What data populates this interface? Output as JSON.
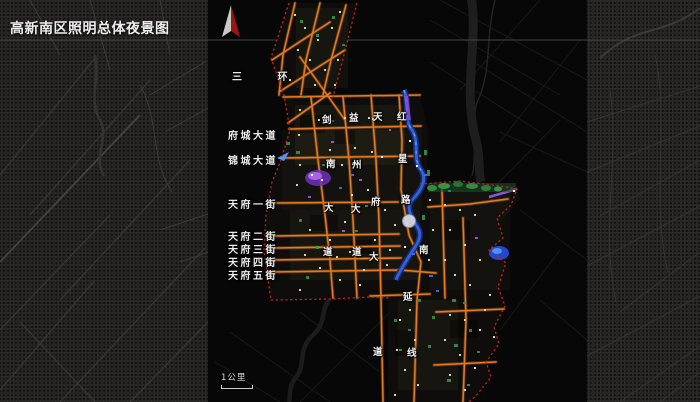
{
  "header": {
    "title": "高新南区照明总体夜景图"
  },
  "margin_labels": {
    "items": [
      {
        "text": "三 环"
      },
      {
        "text": "府城大道"
      },
      {
        "text": "锦城大道"
      },
      {
        "text": "天府一街"
      },
      {
        "text": "天府二街"
      },
      {
        "text": "天府三街"
      },
      {
        "text": "天府四街"
      },
      {
        "text": "天府五街"
      }
    ]
  },
  "map_road_labels": {
    "jiannan": {
      "name": "剑南大道",
      "chars": [
        "剑",
        "南",
        "大",
        "道"
      ]
    },
    "yizhou": {
      "name": "益州大道",
      "chars": [
        "益",
        "州",
        "大",
        "道"
      ]
    },
    "tianfu": {
      "name": "天府大道",
      "chars": [
        "天",
        "府",
        "大",
        "道"
      ]
    },
    "hongxing": {
      "name": "红星路南延线",
      "chars": [
        "红",
        "星",
        "路",
        "南",
        "延",
        "线"
      ]
    }
  },
  "scale_bar": {
    "label": "1公里"
  },
  "icons": {
    "compass": "north-arrow"
  },
  "colors": {
    "road_orange": "#e8791c",
    "boundary_red": "#c32222",
    "river_blue": "#3a66e8",
    "title_text": "#ededed",
    "compass_red": "#9e1414"
  }
}
